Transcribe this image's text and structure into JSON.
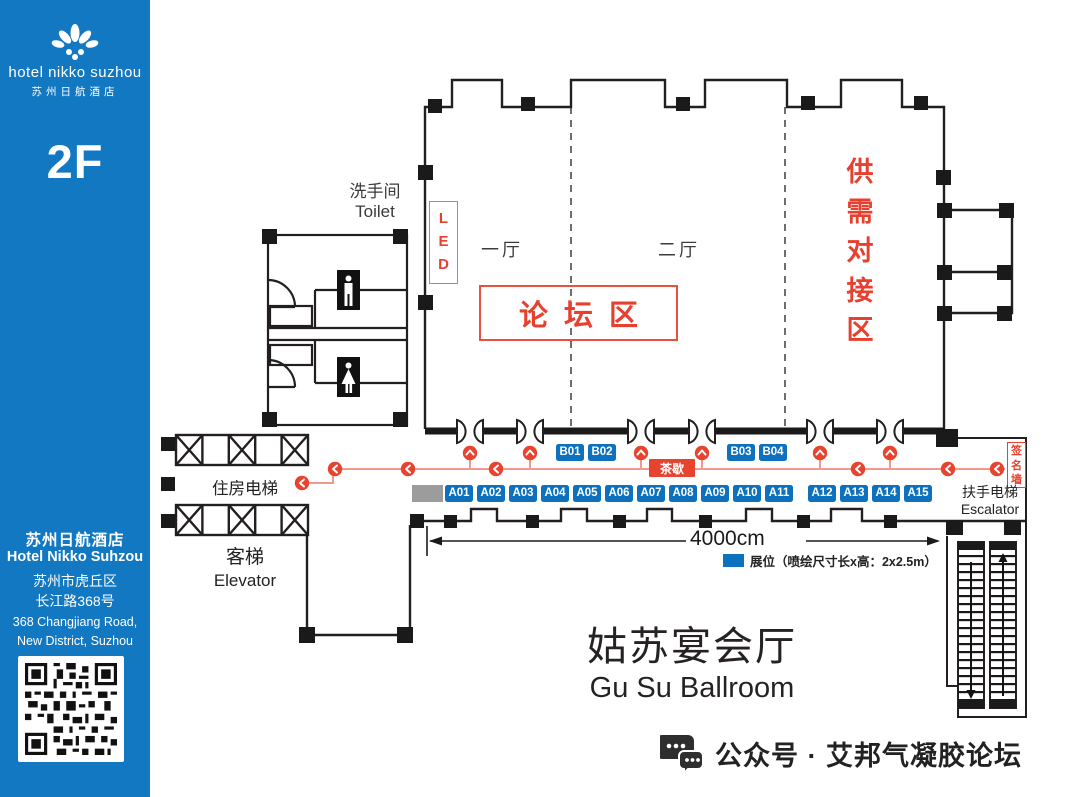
{
  "sidebar": {
    "brand_en": "hotel nikko suzhou",
    "brand_cn": "苏州日航酒店",
    "floor": "2F",
    "hotel_cn": "苏州日航酒店",
    "hotel_en": "Hotel Nikko Suhzou",
    "address_cn": [
      "苏州市虎丘区",
      "长江路368号"
    ],
    "address_en": [
      "368 Changjiang Road,",
      "New District, Suzhou"
    ]
  },
  "plan": {
    "toilet_cn": "洗手间",
    "toilet_en": "Toilet",
    "led": [
      "L",
      "E",
      "D"
    ],
    "hall1": "一厅",
    "hall2": "二厅",
    "forum_zone": "论坛区",
    "supply_zone": [
      "供",
      "需",
      "对",
      "接",
      "区"
    ],
    "sign_wall": [
      "签",
      "名",
      "墙"
    ],
    "tea_break": "茶歇",
    "room_elevator": "住房电梯",
    "elevator_cn": "客梯",
    "elevator_en": "Elevator",
    "escalator_cn": "扶手电梯",
    "escalator_en": "Escalator",
    "dimension": "4000cm",
    "legend_label": "展位（喷绘尺寸长x高：2x2.5m）",
    "booths_b_left": [
      "B01",
      "B02"
    ],
    "booths_b_right": [
      "B03",
      "B04"
    ],
    "booths_a_left": [
      "A01",
      "A02",
      "A03",
      "A04",
      "A05",
      "A06",
      "A07",
      "A08",
      "A09",
      "A10",
      "A11"
    ],
    "booths_a_right": [
      "A12",
      "A13",
      "A14",
      "A15"
    ]
  },
  "title": {
    "cn": "姑苏宴会厅",
    "en": "Gu Su Ballroom"
  },
  "footer": {
    "wechat": "公众号 · 艾邦气凝胶论坛"
  },
  "colors": {
    "sidebar_blue": "#1278c2",
    "booth_blue": "#0e71bd",
    "accent_red": "#e8402f",
    "route_red": "#f4998c"
  }
}
